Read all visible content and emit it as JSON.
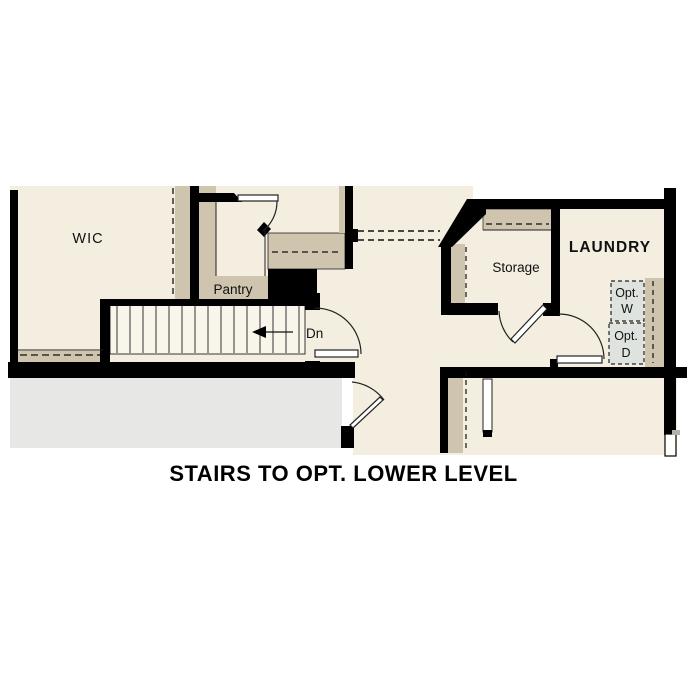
{
  "title": "STAIRS TO OPT. LOWER LEVEL",
  "rooms": {
    "wic": "WIC",
    "pantry": "Pantry",
    "storage": "Storage",
    "laundry": "LAUNDRY"
  },
  "stairs": {
    "direction_label": "Dn"
  },
  "appliances": {
    "washer": {
      "line1": "Opt.",
      "line2": "W"
    },
    "dryer": {
      "line1": "Opt.",
      "line2": "D"
    }
  },
  "colors": {
    "wall": "#000000",
    "room_fill": "#f4eee1",
    "cabinet_tan": "#cfc4ad",
    "slab_gray": "#e7e7e5",
    "appliance_gray": "#dfe3df",
    "stair_fill": "#f9f5ea"
  }
}
